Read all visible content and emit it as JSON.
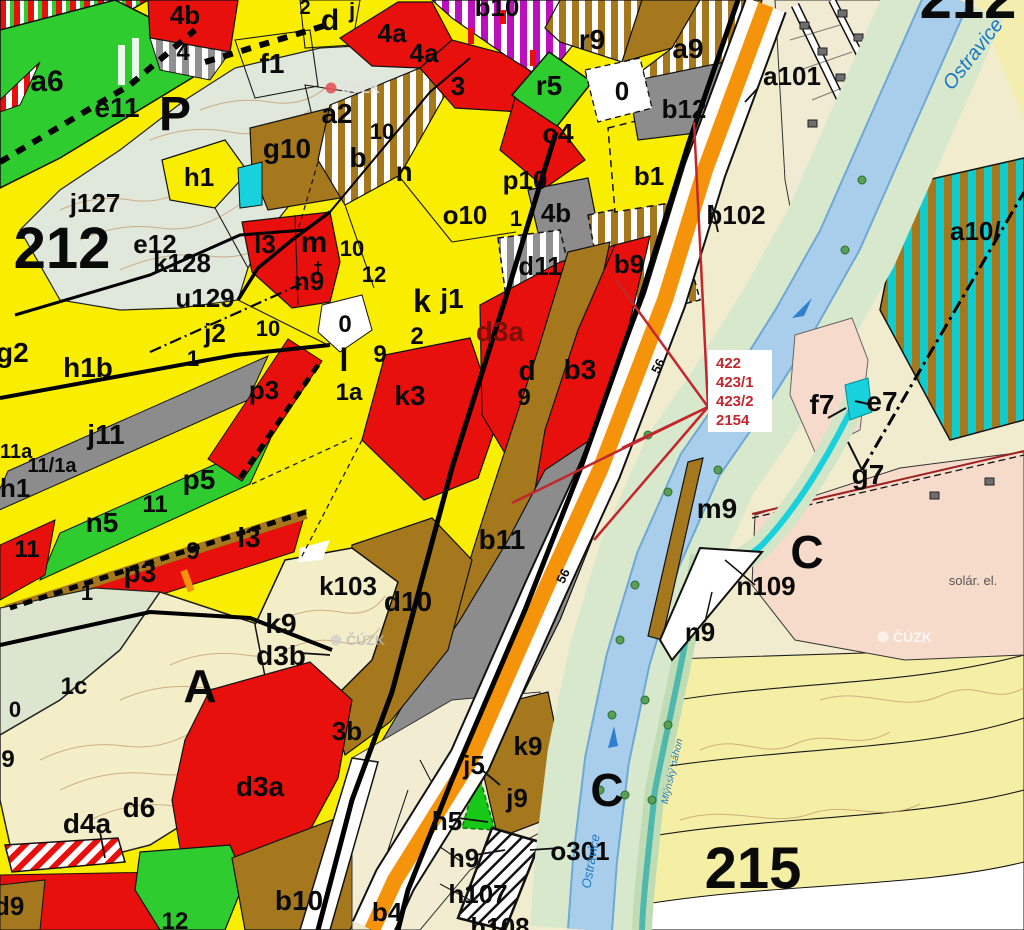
{
  "map": {
    "type": "cadastral-zoning-map",
    "attribution": "ČÚZK",
    "district_numbers": [
      "212",
      "215",
      "212"
    ],
    "road_number": "56",
    "water_features": [
      "Ostravice",
      "Mlýnský náhon"
    ],
    "annotation": {
      "highlight_color": "#C1272D",
      "box": {
        "x": 708,
        "y": 350,
        "w": 64,
        "h": 82
      },
      "parcel_numbers": [
        "422",
        "423/1",
        "423/2",
        "2154"
      ]
    },
    "colors": {
      "zone_yellow": "#FAEE00",
      "zone_red": "#E8100C",
      "zone_green": "#2FCC2F",
      "zone_brown": "#A5781E",
      "zone_gray": "#8C8C8C",
      "zone_purple": "#BB10BB",
      "zone_cyan": "#17D1DC",
      "meadow": "#DFE8DB",
      "field_cream": "#F3EDC8",
      "field_pale_yellow": "#F5EFA6",
      "flood_green": "#D8E8CC",
      "river_blue": "#A9CEEC",
      "road_orange": "#F5930B",
      "solar_pink": "#F6DBCB",
      "river_text": "#1C77C4"
    },
    "labels": [
      {
        "t": "212",
        "x": 62,
        "y": 268,
        "s": 58,
        "n": "district-number"
      },
      {
        "t": "212",
        "x": 968,
        "y": 18,
        "s": 58,
        "n": "district-number"
      },
      {
        "t": "215",
        "x": 753,
        "y": 888,
        "s": 58,
        "n": "district-number"
      },
      {
        "t": "P",
        "x": 175,
        "y": 130,
        "s": 48,
        "n": "zone-label"
      },
      {
        "t": "A",
        "x": 200,
        "y": 702,
        "s": 46,
        "n": "zone-label"
      },
      {
        "t": "C",
        "x": 807,
        "y": 568,
        "s": 46,
        "n": "zone-label"
      },
      {
        "t": "C",
        "x": 607,
        "y": 806,
        "s": 46,
        "n": "zone-label"
      },
      {
        "t": "a6",
        "x": 47,
        "y": 91,
        "s": 30
      },
      {
        "t": "e11",
        "x": 117,
        "y": 117,
        "s": 28
      },
      {
        "t": "h1",
        "x": 199,
        "y": 186,
        "s": 26
      },
      {
        "t": "f1",
        "x": 272,
        "y": 73,
        "s": 28
      },
      {
        "t": "d",
        "x": 330,
        "y": 30,
        "s": 30
      },
      {
        "t": "j",
        "x": 352,
        "y": 18,
        "s": 22
      },
      {
        "t": "2",
        "x": 305,
        "y": 14,
        "s": 20
      },
      {
        "t": "4b",
        "x": 185,
        "y": 24,
        "s": 26
      },
      {
        "t": "4",
        "x": 183,
        "y": 60,
        "s": 24
      },
      {
        "t": "4a",
        "x": 392,
        "y": 42,
        "s": 26
      },
      {
        "t": "4a",
        "x": 424,
        "y": 62,
        "s": 26
      },
      {
        "t": "3",
        "x": 458,
        "y": 95,
        "s": 26
      },
      {
        "t": "b10",
        "x": 497,
        "y": 16,
        "s": 26
      },
      {
        "t": "r9",
        "x": 592,
        "y": 49,
        "s": 28
      },
      {
        "t": "a9",
        "x": 688,
        "y": 58,
        "s": 28
      },
      {
        "t": "a101",
        "x": 792,
        "y": 85,
        "s": 26
      },
      {
        "t": "r5",
        "x": 549,
        "y": 95,
        "s": 28
      },
      {
        "t": "c4",
        "x": 558,
        "y": 143,
        "s": 28
      },
      {
        "t": "a2",
        "x": 337,
        "y": 123,
        "s": 28
      },
      {
        "t": "g10",
        "x": 287,
        "y": 158,
        "s": 28
      },
      {
        "t": "b12",
        "x": 684,
        "y": 118,
        "s": 26
      },
      {
        "t": "0",
        "x": 622,
        "y": 100,
        "s": 26
      },
      {
        "t": "10",
        "x": 382,
        "y": 139,
        "s": 22
      },
      {
        "t": "b",
        "x": 358,
        "y": 167,
        "s": 28
      },
      {
        "t": "n",
        "x": 404,
        "y": 181,
        "s": 28
      },
      {
        "t": "b1",
        "x": 649,
        "y": 185,
        "s": 26
      },
      {
        "t": "j127",
        "x": 95,
        "y": 212,
        "s": 26
      },
      {
        "t": "e12",
        "x": 155,
        "y": 253,
        "s": 26
      },
      {
        "t": "k128",
        "x": 182,
        "y": 272,
        "s": 26
      },
      {
        "t": "o10",
        "x": 465,
        "y": 224,
        "s": 26
      },
      {
        "t": "1",
        "x": 516,
        "y": 226,
        "s": 22
      },
      {
        "t": "4b",
        "x": 556,
        "y": 222,
        "s": 26
      },
      {
        "t": "p10",
        "x": 525,
        "y": 189,
        "s": 26
      },
      {
        "t": "b102",
        "x": 736,
        "y": 224,
        "s": 26
      },
      {
        "t": "d11",
        "x": 540,
        "y": 275,
        "s": 26
      },
      {
        "t": "b9",
        "x": 629,
        "y": 273,
        "s": 26
      },
      {
        "t": "a10/",
        "x": 950,
        "y": 240,
        "s": 26,
        "a": "start"
      },
      {
        "t": "l3",
        "x": 265,
        "y": 253,
        "s": 26
      },
      {
        "t": "m",
        "x": 314,
        "y": 252,
        "s": 30
      },
      {
        "t": "✝",
        "x": 318,
        "y": 272,
        "s": 15
      },
      {
        "t": "n9",
        "x": 309,
        "y": 290,
        "s": 26
      },
      {
        "t": "10",
        "x": 352,
        "y": 256,
        "s": 22
      },
      {
        "t": "u129",
        "x": 205,
        "y": 307,
        "s": 26
      },
      {
        "t": "10",
        "x": 268,
        "y": 336,
        "s": 22
      },
      {
        "t": "12",
        "x": 374,
        "y": 282,
        "s": 22
      },
      {
        "t": "j2",
        "x": 215,
        "y": 342,
        "s": 26
      },
      {
        "t": "1",
        "x": 193,
        "y": 366,
        "s": 22
      },
      {
        "t": "k",
        "x": 422,
        "y": 312,
        "s": 32
      },
      {
        "t": "j1",
        "x": 452,
        "y": 308,
        "s": 28
      },
      {
        "t": "2",
        "x": 417,
        "y": 344,
        "s": 24
      },
      {
        "t": "0",
        "x": 345,
        "y": 332,
        "s": 24
      },
      {
        "t": "9",
        "x": 380,
        "y": 362,
        "s": 24
      },
      {
        "t": "l",
        "x": 344,
        "y": 371,
        "s": 32
      },
      {
        "t": "1a",
        "x": 349,
        "y": 400,
        "s": 24
      },
      {
        "t": "k3",
        "x": 410,
        "y": 405,
        "s": 28
      },
      {
        "t": "d3a",
        "x": 500,
        "y": 341,
        "s": 28,
        "c": "#7A1008"
      },
      {
        "t": "d",
        "x": 527,
        "y": 380,
        "s": 28
      },
      {
        "t": "9",
        "x": 524,
        "y": 405,
        "s": 24
      },
      {
        "t": "b3",
        "x": 580,
        "y": 379,
        "s": 28
      },
      {
        "t": "g2",
        "x": -4,
        "y": 362,
        "s": 28,
        "a": "start"
      },
      {
        "t": "h1b",
        "x": 88,
        "y": 377,
        "s": 28
      },
      {
        "t": "j11",
        "x": 106,
        "y": 444,
        "s": 28
      },
      {
        "t": "11a",
        "x": 0,
        "y": 458,
        "s": 20,
        "a": "start"
      },
      {
        "t": "11/1a",
        "x": 52,
        "y": 472,
        "s": 20
      },
      {
        "t": "h1",
        "x": 0,
        "y": 497,
        "s": 26,
        "a": "start"
      },
      {
        "t": "n5",
        "x": 102,
        "y": 532,
        "s": 28
      },
      {
        "t": "p5",
        "x": 199,
        "y": 489,
        "s": 28
      },
      {
        "t": "11",
        "x": 155,
        "y": 512,
        "s": 24
      },
      {
        "t": "11",
        "x": 27,
        "y": 557,
        "s": 24
      },
      {
        "t": "l3",
        "x": 249,
        "y": 547,
        "s": 28
      },
      {
        "t": "9",
        "x": 193,
        "y": 559,
        "s": 24
      },
      {
        "t": "p3",
        "x": 140,
        "y": 582,
        "s": 28
      },
      {
        "t": "p3",
        "x": 264,
        "y": 399,
        "s": 26
      },
      {
        "t": "1",
        "x": 87,
        "y": 600,
        "s": 22
      },
      {
        "t": "1c",
        "x": 74,
        "y": 694,
        "s": 24
      },
      {
        "t": "9",
        "x": 8,
        "y": 767,
        "s": 24
      },
      {
        "t": "0",
        "x": 15,
        "y": 717,
        "s": 22
      },
      {
        "t": "k103",
        "x": 348,
        "y": 595,
        "s": 26
      },
      {
        "t": "d10",
        "x": 408,
        "y": 611,
        "s": 28
      },
      {
        "t": "k9",
        "x": 281,
        "y": 633,
        "s": 28
      },
      {
        "t": "d3b",
        "x": 281,
        "y": 665,
        "s": 28
      },
      {
        "t": "b11",
        "x": 502,
        "y": 549,
        "s": 28
      },
      {
        "t": "3b",
        "x": 347,
        "y": 740,
        "s": 26
      },
      {
        "t": "d3a",
        "x": 260,
        "y": 796,
        "s": 28
      },
      {
        "t": "d6",
        "x": 139,
        "y": 817,
        "s": 28
      },
      {
        "t": "d4a",
        "x": 87,
        "y": 833,
        "s": 28
      },
      {
        "t": "d9",
        "x": -6,
        "y": 915,
        "s": 26,
        "a": "start"
      },
      {
        "t": "b10",
        "x": 299,
        "y": 910,
        "s": 28
      },
      {
        "t": "12",
        "x": 175,
        "y": 929,
        "s": 24
      },
      {
        "t": "b4",
        "x": 387,
        "y": 921,
        "s": 26
      },
      {
        "t": "j5",
        "x": 474,
        "y": 774,
        "s": 26
      },
      {
        "t": "k9",
        "x": 528,
        "y": 755,
        "s": 26
      },
      {
        "t": "j9",
        "x": 517,
        "y": 807,
        "s": 26
      },
      {
        "t": "h5",
        "x": 447,
        "y": 830,
        "s": 26
      },
      {
        "t": "h9",
        "x": 464,
        "y": 867,
        "s": 26
      },
      {
        "t": "h107",
        "x": 478,
        "y": 903,
        "s": 26
      },
      {
        "t": "h108",
        "x": 500,
        "y": 936,
        "s": 26
      },
      {
        "t": "o301",
        "x": 580,
        "y": 860,
        "s": 26
      },
      {
        "t": "m9",
        "x": 717,
        "y": 518,
        "s": 28
      },
      {
        "t": "n109",
        "x": 766,
        "y": 595,
        "s": 26
      },
      {
        "t": "n9",
        "x": 700,
        "y": 641,
        "s": 26
      },
      {
        "t": "f7",
        "x": 822,
        "y": 414,
        "s": 28
      },
      {
        "t": "e7",
        "x": 882,
        "y": 411,
        "s": 28
      },
      {
        "t": "g7",
        "x": 868,
        "y": 484,
        "s": 28
      },
      {
        "t": "solár. el.",
        "x": 973,
        "y": 585,
        "s": 13,
        "w": 400,
        "c": "#555555",
        "n": "solar-label"
      },
      {
        "t": "56",
        "x": 662,
        "y": 368,
        "s": 13,
        "r": -63,
        "n": "road-number"
      },
      {
        "t": "56",
        "x": 567,
        "y": 578,
        "s": 13,
        "r": -63,
        "n": "road-number"
      },
      {
        "t": "Ostravice",
        "x": 978,
        "y": 58,
        "s": 20,
        "r": -52,
        "c": "#1C77C4",
        "st": "italic",
        "w": 400,
        "n": "river-name-label"
      },
      {
        "t": "Ostravice",
        "x": 595,
        "y": 862,
        "s": 13,
        "r": -80,
        "c": "#1C77C4",
        "st": "italic",
        "w": 400,
        "n": "river-name-label"
      },
      {
        "t": "Mlýnský náhon",
        "x": 675,
        "y": 772,
        "s": 10,
        "r": -77,
        "c": "#1C77C4",
        "st": "italic",
        "w": 400,
        "n": "channel-name-label"
      },
      {
        "t": "ČÚZK",
        "x": 341,
        "y": 93,
        "s": 14,
        "c": "#E2E2E2",
        "a": "start",
        "o": 0.9,
        "n": "watermark"
      },
      {
        "t": "ČÚZK",
        "x": 346,
        "y": 645,
        "s": 14,
        "c": "#BBBBBB",
        "a": "start",
        "o": 0.8,
        "n": "watermark"
      },
      {
        "t": "ČÚZK",
        "x": 893,
        "y": 642,
        "s": 14,
        "c": "#FFFFFF",
        "a": "start",
        "o": 0.75,
        "n": "watermark"
      }
    ]
  }
}
